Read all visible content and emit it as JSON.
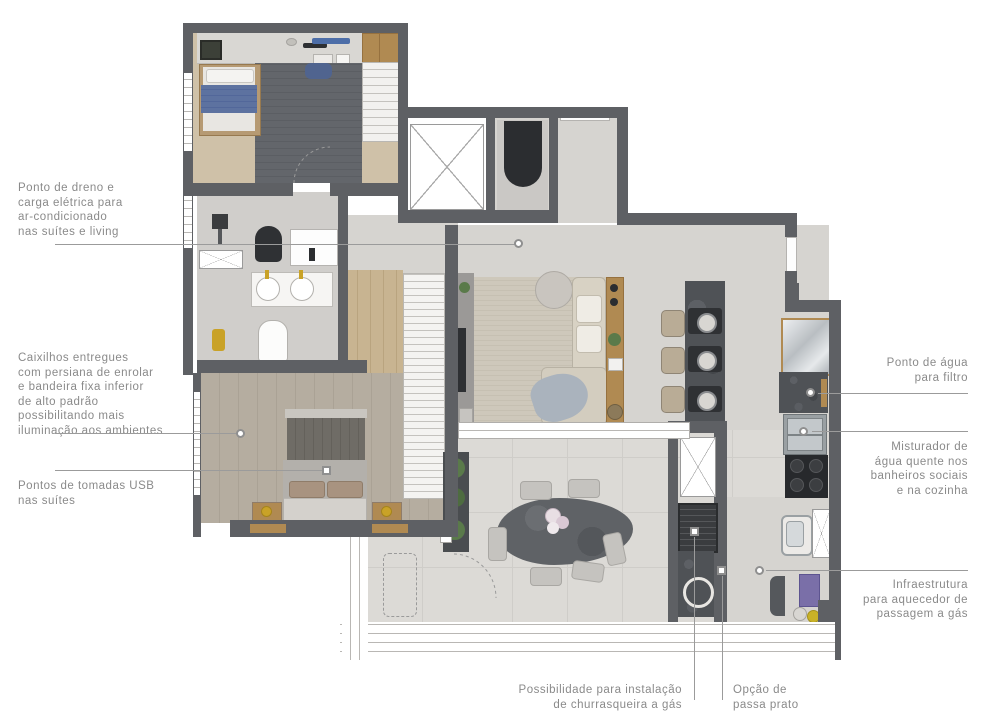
{
  "title": "Planta de apartamento com anotações",
  "annotations": {
    "left": [
      {
        "id": "ac-drain",
        "text": "Ponto de dreno e\ncarga elétrica para\nar-condicionado\nnas suítes e living"
      },
      {
        "id": "window-frames",
        "text": "Caixilhos entregues\ncom persiana de enrolar\ne bandeira fixa inferior\nde alto padrão\npossibilitando mais\niluminação aos ambientes"
      },
      {
        "id": "usb-outlets",
        "text": "Pontos de tomadas USB\nnas suítes"
      }
    ],
    "right": [
      {
        "id": "water-filter",
        "text": "Ponto de água\npara filtro"
      },
      {
        "id": "hot-water-mixer",
        "text": "Misturador de\nágua quente nos\nbanheiros sociais\ne na cozinha"
      },
      {
        "id": "gas-heater",
        "text": "Infraestrutura\npara aquecedor de\npassagem a gás"
      }
    ],
    "bottom": [
      {
        "id": "bbq",
        "text": "Possibilidade para instalação\nde churrasqueira a gás"
      },
      {
        "id": "pass-through",
        "text": "Opção de\npassa prato"
      }
    ]
  },
  "palette": {
    "wall": "#5e6064",
    "floor": "#d6d4d0",
    "terrace_floor": "#dcdad6",
    "wood_light": "#cfc1a8",
    "wood_mid": "#b08a52",
    "marble_dark": "#4f5256",
    "rug_dark": "#63666b",
    "rug_beige": "#cec8bb",
    "bed_blue": "#5d72a0",
    "annotation_text": "#8a8a8a",
    "leader_line": "#9b9b9b"
  }
}
